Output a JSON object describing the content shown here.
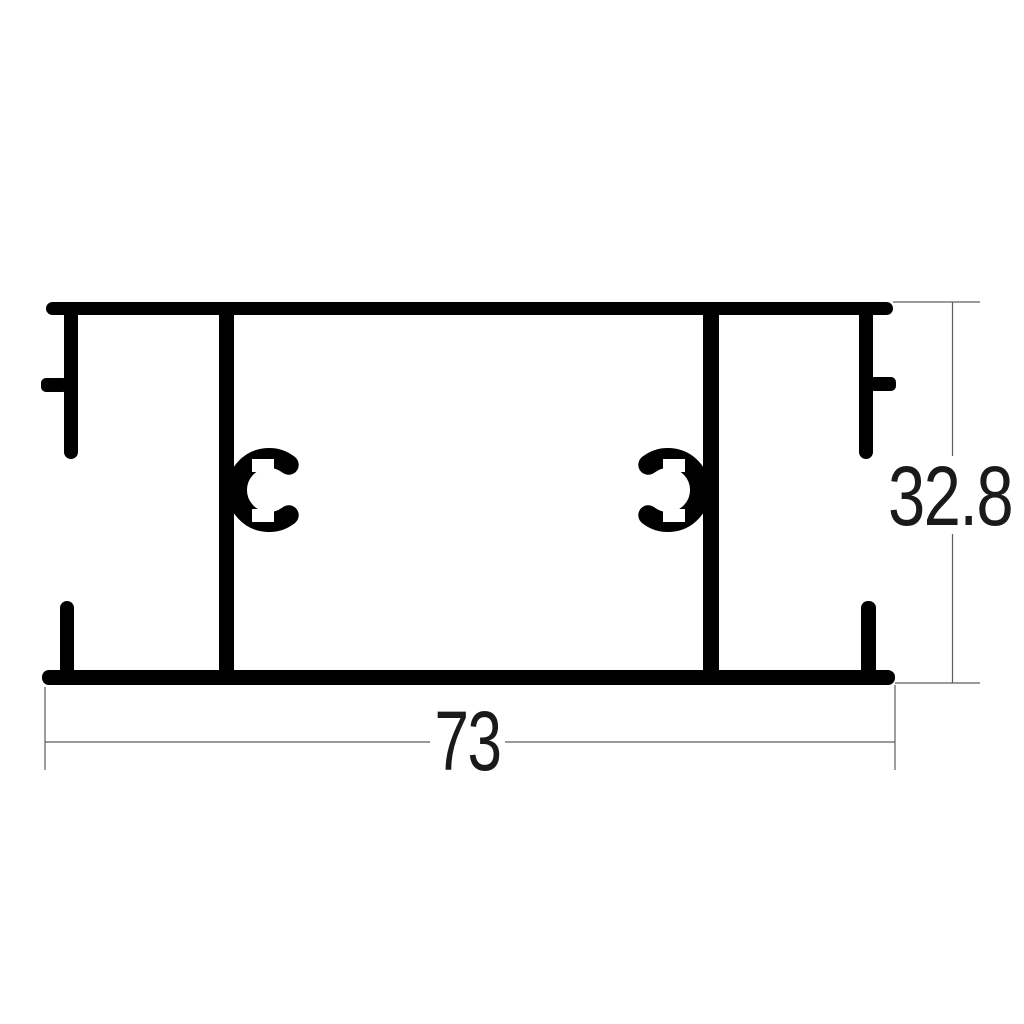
{
  "page": {
    "background": "#ffffff"
  },
  "drawing": {
    "kind": "aluminium-profile-cross-section",
    "profile_color": "#000000",
    "dim_line_color": "#5d5d5d",
    "dim_text_color": "#1a1a1a"
  },
  "dimensions": {
    "width": {
      "label": "73"
    },
    "height": {
      "label": "32.8"
    }
  }
}
